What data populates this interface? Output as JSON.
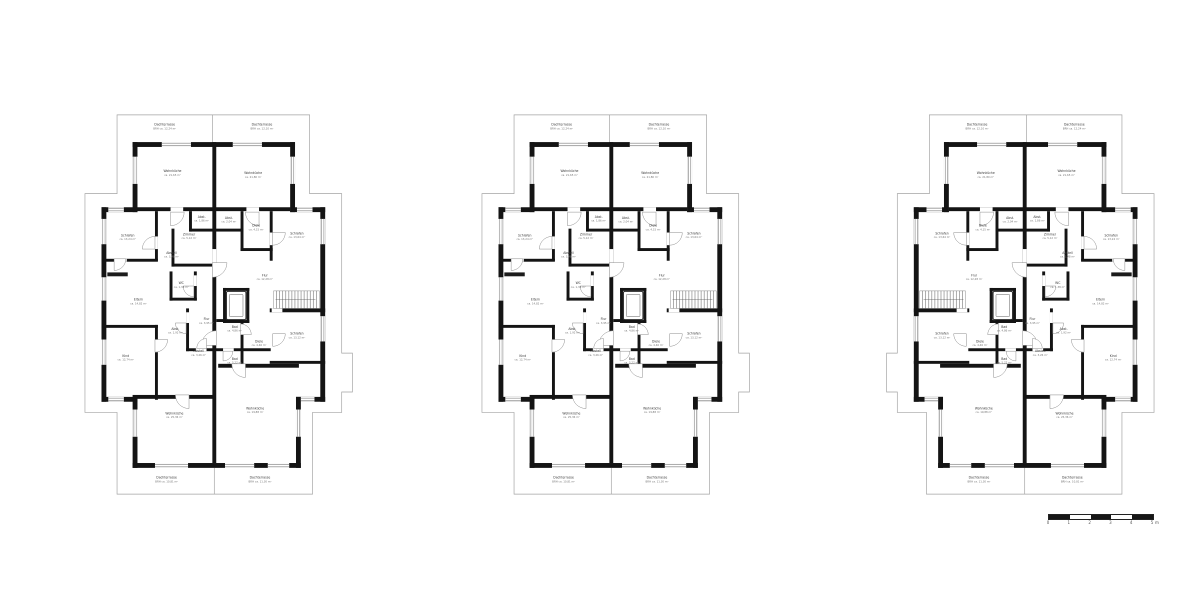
{
  "page": {
    "background": "#ffffff",
    "description_labels": []
  },
  "colors": {
    "wall": "#141414",
    "roof_line": "#a3a3a3",
    "window_line": "#7d7d7d",
    "door_line": "#8a8a8a",
    "label": "#3a3a3a",
    "area": "#767676",
    "stair_hatch": "#565656"
  },
  "plans": [
    {
      "name": "floor-plan-left",
      "mirrored": false
    },
    {
      "name": "floor-plan-center",
      "mirrored": false
    },
    {
      "name": "floor-plan-right",
      "mirrored": true
    }
  ],
  "rooms": [
    {
      "id": "terrace-top-left",
      "label": "Dachterrasse",
      "area": "BRH ca. 12,24 m²",
      "x": 88,
      "y": 16
    },
    {
      "id": "terrace-top-right",
      "label": "Dachterrasse",
      "area": "BRH ca. 12,10 m²",
      "x": 188,
      "y": 16
    },
    {
      "id": "wohnkueche-top-left",
      "label": "Wohnküche",
      "area": "ca. 21,65 m²",
      "x": 96,
      "y": 64
    },
    {
      "id": "wohnkueche-top-right",
      "label": "Wohnküche",
      "area": "ca. 21,80 m²",
      "x": 179,
      "y": 66
    },
    {
      "id": "schlafen-upper-left",
      "label": "Schlafen",
      "area": "ca. 13,24 m²",
      "x": 50,
      "y": 130
    },
    {
      "id": "abst-upper-left",
      "label": "Abst.",
      "area": "ca. 1,86 m²",
      "x": 126,
      "y": 111
    },
    {
      "id": "abst-upper-right",
      "label": "Abst.",
      "area": "ca. 2,04 m²",
      "x": 154,
      "y": 112
    },
    {
      "id": "diele-upper-right",
      "label": "Diele",
      "area": "ca. 4,15 m²",
      "x": 182,
      "y": 120
    },
    {
      "id": "zimmer-center",
      "label": "Zimmer",
      "area": "ca. 5,12 m²",
      "x": 113,
      "y": 129
    },
    {
      "id": "abstell-left",
      "label": "Abstell",
      "area": "ca. 3,48 m²",
      "x": 95,
      "y": 148
    },
    {
      "id": "schlafen-upper-right",
      "label": "Schlafen",
      "area": "ca. 13,64 m²",
      "x": 224,
      "y": 128
    },
    {
      "id": "flur-right",
      "label": "Flur",
      "area": "ca. 12,28 m²",
      "x": 191,
      "y": 171
    },
    {
      "id": "wc-center",
      "label": "WC",
      "area": "ca. 1,38 m²",
      "x": 105,
      "y": 179
    },
    {
      "id": "eltern-left",
      "label": "Eltern",
      "area": "ca. 14,82 m²",
      "x": 61,
      "y": 196
    },
    {
      "id": "abst-mid",
      "label": "Abst.",
      "area": "ca. 1,92 m²",
      "x": 99,
      "y": 226
    },
    {
      "id": "flur-small",
      "label": "Flur",
      "area": "ca. 3,95 m²",
      "x": 131,
      "y": 216
    },
    {
      "id": "bad-center",
      "label": "Bad",
      "area": "ca. 4,86 m²",
      "x": 160,
      "y": 224
    },
    {
      "id": "diele-lower",
      "label": "Diele",
      "area": "ca. 4,46 m²",
      "x": 185,
      "y": 239
    },
    {
      "id": "schlafen-lower-right",
      "label": "Schlafen",
      "area": "ca. 13,12 m²",
      "x": 224,
      "y": 231
    },
    {
      "id": "kind-left",
      "label": "Kind",
      "area": "ca. 12,74 m²",
      "x": 48,
      "y": 254
    },
    {
      "id": "abstell-lower",
      "label": "Abstell",
      "area": "ca. 3,26 m²",
      "x": 123,
      "y": 249
    },
    {
      "id": "bad-lower",
      "label": "Bad",
      "area": "ca. 5,22 m²",
      "x": 160,
      "y": 257
    },
    {
      "id": "wohnkueche-bottom-left",
      "label": "Wohnküche",
      "area": "ca. 25,36 m²",
      "x": 98,
      "y": 313
    },
    {
      "id": "wohnkueche-bottom-right",
      "label": "Wohnküche",
      "area": "ca. 19,88 m²",
      "x": 181,
      "y": 308
    },
    {
      "id": "terrace-bottom-left",
      "label": "Dachterrasse",
      "area": "BRH ca. 10,81 m²",
      "x": 90,
      "y": 379
    },
    {
      "id": "terrace-bottom-right",
      "label": "Dachterrasse",
      "area": "BRH ca. 11,30 m²",
      "x": 186,
      "y": 379
    }
  ],
  "scalebar": {
    "tick_labels": [
      "0",
      "1",
      "2",
      "3",
      "4",
      "5"
    ],
    "unit_label": "m"
  }
}
